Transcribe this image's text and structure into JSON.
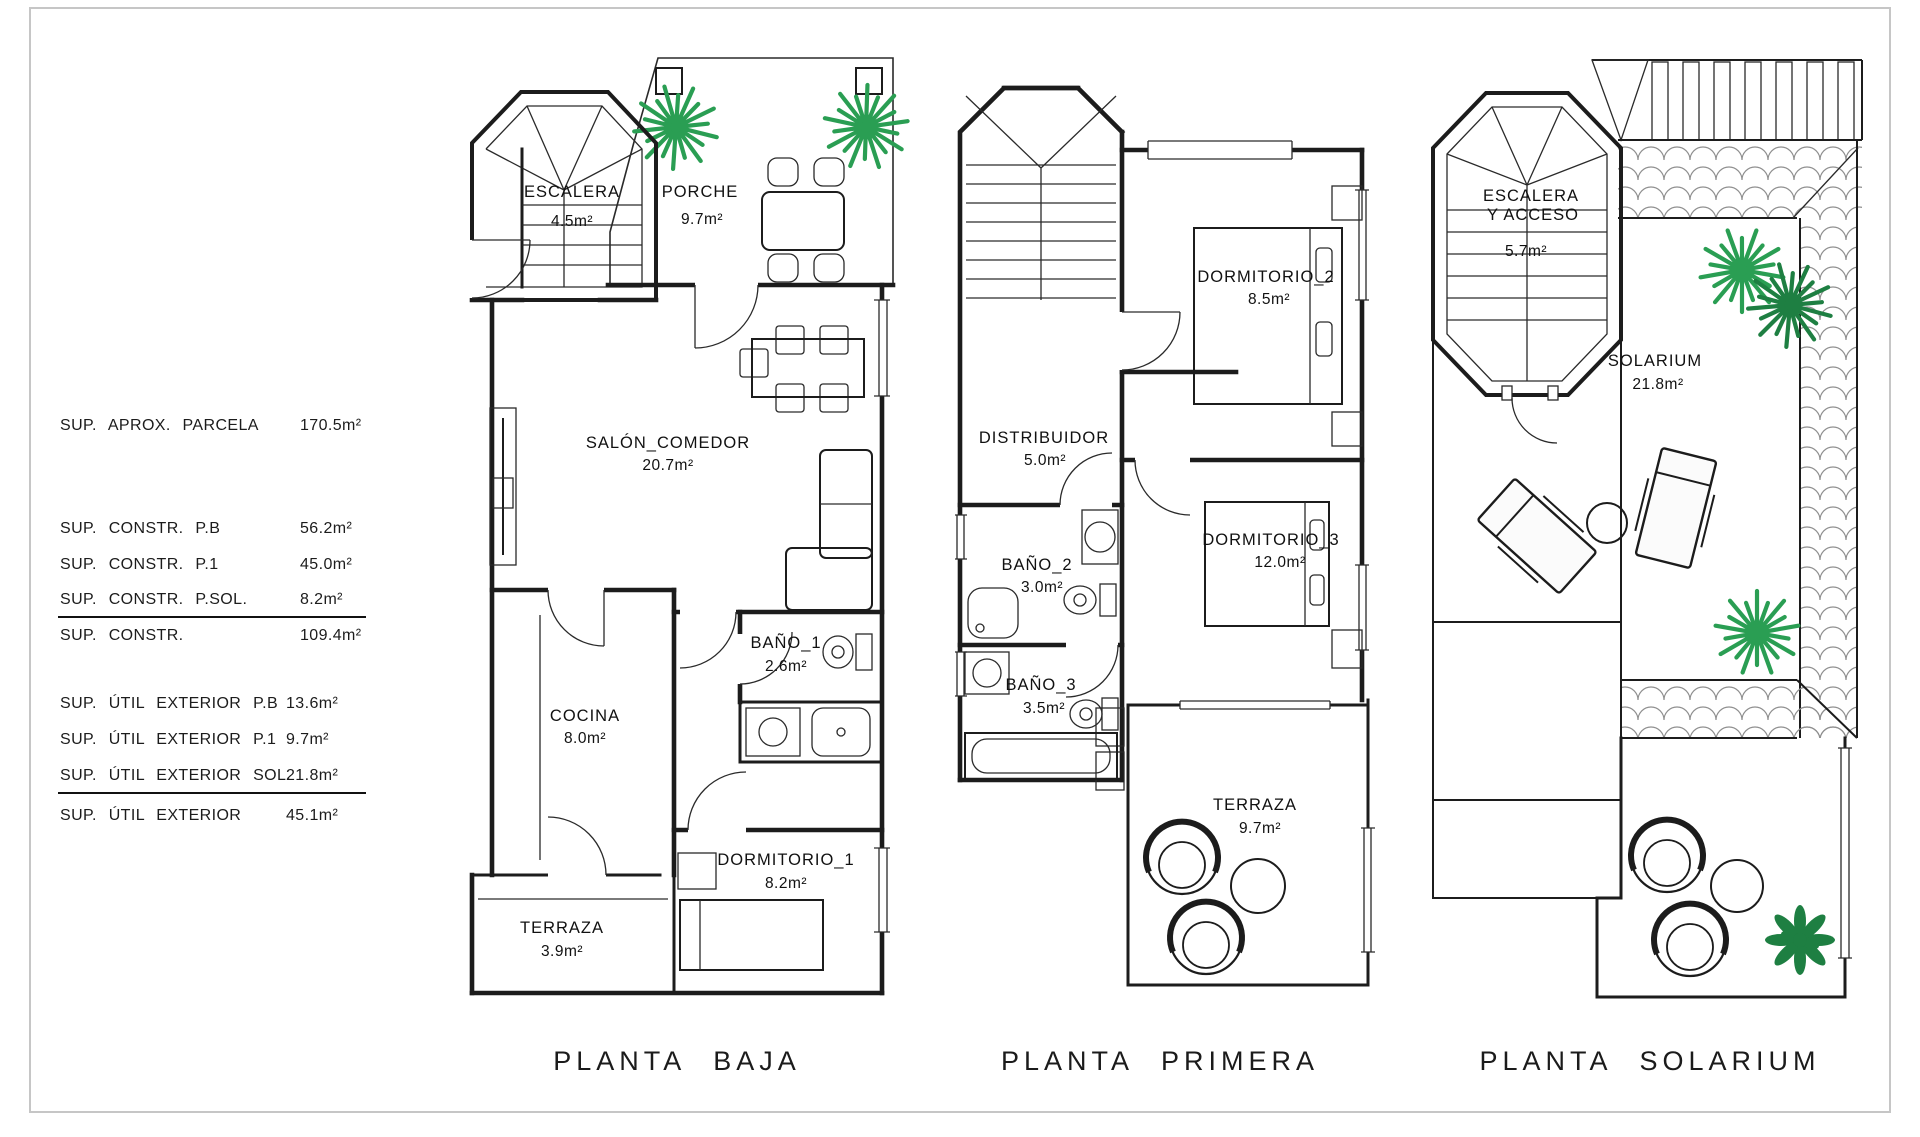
{
  "summary": {
    "parcela": {
      "label": "SUP. APROX. PARCELA",
      "value": "170.5m²"
    },
    "constr": {
      "rows": [
        {
          "label": "SUP. CONSTR. P.B",
          "value": "56.2m²"
        },
        {
          "label": "SUP. CONSTR. P.1",
          "value": "45.0m²"
        },
        {
          "label": "SUP. CONSTR. P.SOL.",
          "value": "8.2m²"
        }
      ],
      "total": {
        "label": "SUP. CONSTR.",
        "value": "109.4m²"
      }
    },
    "util": {
      "rows": [
        {
          "label": "SUP. ÚTIL EXTERIOR P.B",
          "value": "13.6m²"
        },
        {
          "label": "SUP. ÚTIL EXTERIOR P.1",
          "value": "9.7m²"
        },
        {
          "label": "SUP. ÚTIL EXTERIOR SOL.",
          "value": "21.8m²"
        }
      ],
      "total": {
        "label": "SUP. ÚTIL EXTERIOR",
        "value": "45.1m²"
      }
    }
  },
  "plans": {
    "baja": {
      "title": "PLANTA BAJA",
      "rooms": {
        "escalera": {
          "name": "ESCALERA",
          "area": "4.5m²"
        },
        "porche": {
          "name": "PORCHE",
          "area": "9.7m²"
        },
        "salon": {
          "name": "SALÓN_COMEDOR",
          "area": "20.7m²"
        },
        "bano1": {
          "name": "BAÑO_1",
          "area": "2.6m²"
        },
        "cocina": {
          "name": "COCINA",
          "area": "8.0m²"
        },
        "dorm1": {
          "name": "DORMITORIO_1",
          "area": "8.2m²"
        },
        "terraza": {
          "name": "TERRAZA",
          "area": "3.9m²"
        }
      }
    },
    "primera": {
      "title": "PLANTA PRIMERA",
      "rooms": {
        "dorm2": {
          "name": "DORMITORIO_2",
          "area": "8.5m²"
        },
        "distribuidor": {
          "name": "DISTRIBUIDOR",
          "area": "5.0m²"
        },
        "bano2": {
          "name": "BAÑO_2",
          "area": "3.0m²"
        },
        "dorm3": {
          "name": "DORMITORIO_3",
          "area": "12.0m²"
        },
        "bano3": {
          "name": "BAÑO_3",
          "area": "3.5m²"
        },
        "terraza": {
          "name": "TERRAZA",
          "area": "9.7m²"
        }
      }
    },
    "solarium": {
      "title": "PLANTA SOLARIUM",
      "rooms": {
        "escalera": {
          "name1": "ESCALERA",
          "name2": "Y ACCESO",
          "area": "5.7m²"
        },
        "solarium": {
          "name": "SOLARIUM",
          "area": "21.8m²"
        }
      }
    }
  },
  "colors": {
    "line": "#1c1c1c",
    "hatch": "#9a9a9a",
    "plant_green": "#2a9e53",
    "plant_dark": "#1e7f42",
    "page_border": "#c6c6c6"
  }
}
